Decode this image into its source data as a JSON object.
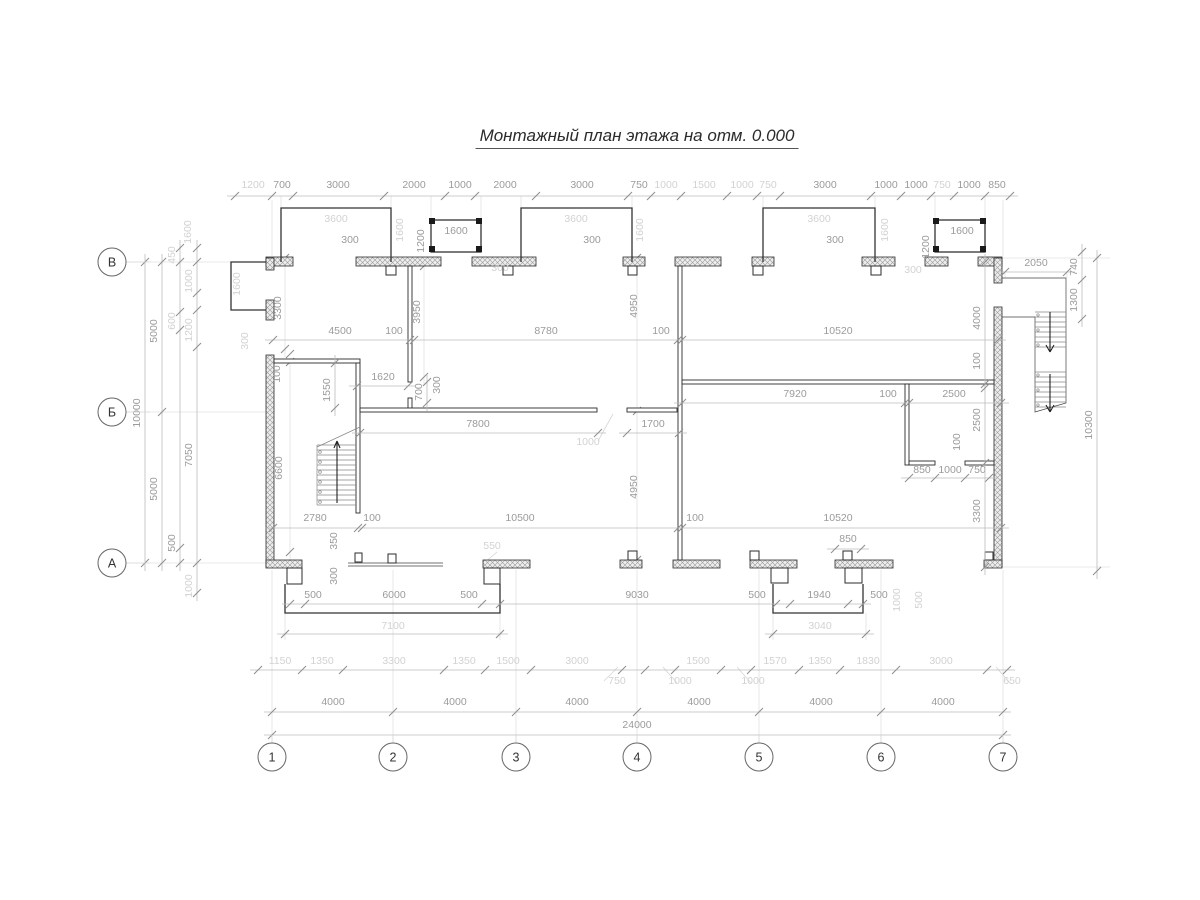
{
  "title": "Монтажный план этажа на отм. 0.000",
  "colors": {
    "wall": "#2b2b2b",
    "dim": "#9b9b9b",
    "dim_light": "#d2d2d2",
    "line": "#bcbcbc",
    "bg": "#ffffff"
  },
  "grid": {
    "radius": 14,
    "column_y": 757,
    "row_x": 112,
    "columns": [
      {
        "label": "1",
        "x": 272
      },
      {
        "label": "2",
        "x": 393
      },
      {
        "label": "3",
        "x": 516
      },
      {
        "label": "4",
        "x": 637
      },
      {
        "label": "5",
        "x": 759
      },
      {
        "label": "6",
        "x": 881
      },
      {
        "label": "7",
        "x": 1003
      }
    ],
    "rows": [
      {
        "label": "В",
        "y": 262
      },
      {
        "label": "Б",
        "y": 412
      },
      {
        "label": "А",
        "y": 563
      }
    ]
  },
  "dim_chains": [
    {
      "name": "dim-top-main",
      "dir": "h",
      "y": 196,
      "label_dy": -8,
      "ticks": [
        235,
        272,
        293,
        384,
        445,
        475,
        536,
        628,
        651,
        681,
        727,
        757,
        780,
        871,
        901,
        931,
        954,
        985,
        1010
      ],
      "labels": [
        {
          "t": "1200",
          "x": 253,
          "tone": "light"
        },
        {
          "t": "700",
          "x": 282
        },
        {
          "t": "3000",
          "x": 338
        },
        {
          "t": "2000",
          "x": 414
        },
        {
          "t": "1000",
          "x": 460
        },
        {
          "t": "2000",
          "x": 505
        },
        {
          "t": "3000",
          "x": 582
        },
        {
          "t": "750",
          "x": 639
        },
        {
          "t": "1000",
          "x": 666,
          "tone": "light"
        },
        {
          "t": "1500",
          "x": 704,
          "tone": "light"
        },
        {
          "t": "1000",
          "x": 742,
          "tone": "light"
        },
        {
          "t": "750",
          "x": 768,
          "tone": "light"
        },
        {
          "t": "3000",
          "x": 825
        },
        {
          "t": "1000",
          "x": 886
        },
        {
          "t": "1000",
          "x": 916
        },
        {
          "t": "750",
          "x": 942,
          "tone": "light"
        },
        {
          "t": "1000",
          "x": 969
        },
        {
          "t": "850",
          "x": 997
        }
      ]
    },
    {
      "name": "dim-2050",
      "dir": "h",
      "y": 272,
      "label_dy": -6,
      "ticks": [
        1005,
        1067
      ],
      "labels": [
        {
          "t": "2050",
          "x": 1036
        }
      ]
    },
    {
      "name": "dim-mid-left",
      "dir": "h",
      "y": 340,
      "label_dy": -6,
      "ticks": [
        273,
        410,
        414,
        678,
        682,
        998
      ],
      "labels": [
        {
          "t": "4500",
          "x": 340
        },
        {
          "t": "100",
          "x": 394
        },
        {
          "t": "8780",
          "x": 546
        },
        {
          "t": "100",
          "x": 661
        },
        {
          "t": "10520",
          "x": 838
        }
      ]
    },
    {
      "name": "dim-mid-right",
      "dir": "h",
      "y": 403,
      "label_dy": -6,
      "ticks": [
        682,
        905,
        909,
        1001
      ],
      "labels": [
        {
          "t": "7920",
          "x": 795
        },
        {
          "t": "100",
          "x": 888
        },
        {
          "t": "2500",
          "x": 954
        }
      ]
    },
    {
      "name": "dim-7800",
      "dir": "h",
      "y": 433,
      "label_dy": -6,
      "ticks": [
        360,
        598
      ],
      "labels": [
        {
          "t": "7800",
          "x": 478
        }
      ]
    },
    {
      "name": "dim-1700",
      "dir": "h",
      "y": 433,
      "label_dy": -6,
      "ticks": [
        627,
        679
      ],
      "labels": [
        {
          "t": "1700",
          "x": 653
        }
      ]
    },
    {
      "name": "dim-1620",
      "dir": "h",
      "y": 386,
      "label_dy": -6,
      "ticks": [
        357,
        408
      ],
      "labels": [
        {
          "t": "1620",
          "x": 383
        }
      ]
    },
    {
      "name": "dim-bottom-inner",
      "dir": "h",
      "y": 528,
      "label_dy": -7,
      "ticks": [
        273,
        358,
        362,
        678,
        682,
        1001
      ],
      "labels": [
        {
          "t": "2780",
          "x": 315
        },
        {
          "t": "100",
          "x": 372
        },
        {
          "t": "10500",
          "x": 520
        },
        {
          "t": "100",
          "x": 695
        },
        {
          "t": "10520",
          "x": 838
        }
      ]
    },
    {
      "name": "dim-850-bottom",
      "dir": "h",
      "y": 549,
      "label_dy": -7,
      "ticks": [
        835,
        861
      ],
      "labels": [
        {
          "t": "850",
          "x": 848
        }
      ]
    },
    {
      "name": "dim-wc",
      "dir": "h",
      "y": 478,
      "label_dy": -5,
      "ticks": [
        909,
        935,
        965,
        989
      ],
      "labels": [
        {
          "t": "850",
          "x": 922
        },
        {
          "t": "1000",
          "x": 950
        },
        {
          "t": "750",
          "x": 977
        }
      ]
    },
    {
      "name": "dim-porches",
      "dir": "h",
      "y": 604,
      "label_dy": -6,
      "ticks": [
        290,
        305,
        482,
        500,
        776,
        790,
        848,
        863
      ],
      "labels": [
        {
          "t": "500",
          "x": 313
        },
        {
          "t": "6000",
          "x": 394
        },
        {
          "t": "500",
          "x": 469
        },
        {
          "t": "9030",
          "x": 637
        },
        {
          "t": "500",
          "x": 757
        },
        {
          "t": "1940",
          "x": 819
        },
        {
          "t": "500",
          "x": 879
        }
      ]
    },
    {
      "name": "dim-7100",
      "dir": "h",
      "y": 634,
      "label_dy": -5,
      "ticks": [
        285,
        500
      ],
      "labels": [
        {
          "t": "7100",
          "x": 393,
          "tone": "light"
        }
      ]
    },
    {
      "name": "dim-3040",
      "dir": "h",
      "y": 634,
      "label_dy": -5,
      "ticks": [
        773,
        866
      ],
      "labels": [
        {
          "t": "3040",
          "x": 820,
          "tone": "light"
        }
      ]
    },
    {
      "name": "dim-secondary-row",
      "dir": "h",
      "y": 670,
      "label_dy": -6,
      "ticks": [
        258,
        302,
        343,
        444,
        485,
        531,
        622,
        645,
        675,
        721,
        751,
        799,
        840,
        896,
        987,
        1007
      ],
      "labels": [
        {
          "t": "1150",
          "x": 280,
          "tone": "light"
        },
        {
          "t": "1350",
          "x": 322,
          "tone": "light"
        },
        {
          "t": "3300",
          "x": 394,
          "tone": "light"
        },
        {
          "t": "1350",
          "x": 464,
          "tone": "light"
        },
        {
          "t": "1500",
          "x": 508,
          "tone": "light"
        },
        {
          "t": "3000",
          "x": 577,
          "tone": "light"
        },
        {
          "t": "750",
          "x": 617,
          "dy": 14,
          "tone": "light"
        },
        {
          "t": "1000",
          "x": 680,
          "dy": 14,
          "tone": "light"
        },
        {
          "t": "1500",
          "x": 698,
          "tone": "light"
        },
        {
          "t": "1000",
          "x": 753,
          "dy": 14,
          "tone": "light"
        },
        {
          "t": "1570",
          "x": 775,
          "tone": "light"
        },
        {
          "t": "1350",
          "x": 820,
          "tone": "light"
        },
        {
          "t": "1830",
          "x": 868,
          "tone": "light"
        },
        {
          "t": "3000",
          "x": 941,
          "tone": "light"
        },
        {
          "t": "650",
          "x": 1012,
          "dy": 14,
          "tone": "light"
        }
      ]
    },
    {
      "name": "dim-4000-row",
      "dir": "h",
      "y": 712,
      "label_dy": -7,
      "ticks": [
        272,
        393,
        516,
        637,
        759,
        881,
        1003
      ],
      "labels": [
        {
          "t": "4000",
          "x": 333
        },
        {
          "t": "4000",
          "x": 455
        },
        {
          "t": "4000",
          "x": 577
        },
        {
          "t": "4000",
          "x": 699
        },
        {
          "t": "4000",
          "x": 821
        },
        {
          "t": "4000",
          "x": 943
        }
      ]
    },
    {
      "name": "dim-24000",
      "dir": "h",
      "y": 735,
      "label_dy": -7,
      "ticks": [
        272,
        1003
      ],
      "labels": [
        {
          "t": "24000",
          "x": 637
        }
      ]
    },
    {
      "name": "dim-left-10000",
      "dir": "v",
      "x": 145,
      "ticks": [
        262,
        563
      ],
      "labels": [
        {
          "t": "10000",
          "y": 413
        }
      ]
    },
    {
      "name": "dim-left-5000",
      "dir": "v",
      "x": 162,
      "ticks": [
        262,
        412,
        563
      ],
      "labels": [
        {
          "t": "5000",
          "y": 331
        },
        {
          "t": "5000",
          "y": 489
        }
      ]
    },
    {
      "name": "dim-left-a",
      "dir": "v",
      "x": 180,
      "ticks": [
        248,
        262,
        312,
        330,
        548,
        563
      ],
      "labels": [
        {
          "t": "450",
          "y": 255,
          "tone": "light"
        },
        {
          "t": "600",
          "y": 321,
          "tone": "light"
        },
        {
          "t": "500",
          "y": 543
        }
      ]
    },
    {
      "name": "dim-left-b",
      "dir": "v",
      "x": 197,
      "ticks": [
        248,
        262,
        293,
        310,
        347,
        563,
        593
      ],
      "labels": [
        {
          "t": "1000",
          "y": 281,
          "tone": "light"
        },
        {
          "t": "1200",
          "y": 330,
          "tone": "light"
        },
        {
          "t": "7050",
          "y": 455
        },
        {
          "t": "1000",
          "y": 586,
          "tone": "light"
        }
      ]
    },
    {
      "name": "dim-right-740",
      "dir": "v",
      "x": 1082,
      "ticks": [
        252,
        280,
        319
      ],
      "labels": [
        {
          "t": "740",
          "y": 267
        },
        {
          "t": "1300",
          "y": 300
        }
      ]
    },
    {
      "name": "dim-right-10300",
      "dir": "v",
      "x": 1097,
      "ticks": [
        258,
        571
      ],
      "labels": [
        {
          "t": "10300",
          "y": 425
        }
      ]
    },
    {
      "name": "dim-right-inner",
      "dir": "v",
      "x": 985,
      "ticks": [
        262,
        384,
        388,
        463,
        567
      ],
      "labels": [
        {
          "t": "4000",
          "y": 318
        },
        {
          "t": "100",
          "y": 361
        },
        {
          "t": "2500",
          "y": 420
        },
        {
          "t": "3300",
          "y": 511
        }
      ]
    },
    {
      "name": "dim-1550",
      "dir": "v",
      "x": 335,
      "ticks": [
        363,
        408
      ],
      "labels": [
        {
          "t": "1550",
          "y": 390
        }
      ]
    },
    {
      "name": "dim-700",
      "dir": "v",
      "x": 427,
      "ticks": [
        382,
        403
      ],
      "labels": [
        {
          "t": "700",
          "y": 392
        }
      ]
    }
  ],
  "free_labels": [
    {
      "t": "3600",
      "x": 336,
      "y": 222,
      "tone": "light"
    },
    {
      "t": "3600",
      "x": 576,
      "y": 222,
      "tone": "light"
    },
    {
      "t": "3600",
      "x": 819,
      "y": 222,
      "tone": "light"
    },
    {
      "t": "300",
      "x": 350,
      "y": 243
    },
    {
      "t": "300",
      "x": 592,
      "y": 243
    },
    {
      "t": "300",
      "x": 835,
      "y": 243
    },
    {
      "t": "1600",
      "x": 456,
      "y": 234
    },
    {
      "t": "1600",
      "x": 962,
      "y": 234
    },
    {
      "t": "1200",
      "x": 424,
      "y": 241,
      "rot": 90
    },
    {
      "t": "1200",
      "x": 929,
      "y": 247,
      "rot": 90
    },
    {
      "t": "1600",
      "x": 403,
      "y": 230,
      "rot": 90,
      "tone": "light"
    },
    {
      "t": "1600",
      "x": 643,
      "y": 230,
      "rot": 90,
      "tone": "light"
    },
    {
      "t": "1600",
      "x": 888,
      "y": 230,
      "rot": 90,
      "tone": "light"
    },
    {
      "t": "1600",
      "x": 240,
      "y": 284,
      "rot": 90,
      "tone": "light"
    },
    {
      "t": "1600",
      "x": 191,
      "y": 232,
      "rot": 90,
      "tone": "light"
    },
    {
      "t": "300",
      "x": 500,
      "y": 271,
      "tone": "light"
    },
    {
      "t": "300",
      "x": 913,
      "y": 273,
      "tone": "light"
    },
    {
      "t": "300",
      "x": 248,
      "y": 341,
      "rot": 90,
      "tone": "light"
    },
    {
      "t": "3300",
      "x": 281,
      "y": 308,
      "rot": 90
    },
    {
      "t": "3950",
      "x": 420,
      "y": 312,
      "rot": 90
    },
    {
      "t": "4950",
      "x": 637,
      "y": 306,
      "rot": 90
    },
    {
      "t": "4950",
      "x": 637,
      "y": 487,
      "rot": 90
    },
    {
      "t": "100",
      "x": 280,
      "y": 374,
      "rot": 90
    },
    {
      "t": "300",
      "x": 440,
      "y": 385,
      "rot": 90
    },
    {
      "t": "1000",
      "x": 588,
      "y": 445,
      "tone": "light"
    },
    {
      "t": "6600",
      "x": 282,
      "y": 468,
      "rot": 90
    },
    {
      "t": "350",
      "x": 337,
      "y": 541,
      "rot": 90
    },
    {
      "t": "300",
      "x": 337,
      "y": 576,
      "rot": 90
    },
    {
      "t": "550",
      "x": 492,
      "y": 549,
      "tone": "light"
    },
    {
      "t": "100",
      "x": 960,
      "y": 442,
      "rot": 90
    },
    {
      "t": "1000",
      "x": 900,
      "y": 600,
      "rot": 90,
      "tone": "light"
    },
    {
      "t": "500",
      "x": 922,
      "y": 600,
      "rot": 90,
      "tone": "light"
    }
  ]
}
